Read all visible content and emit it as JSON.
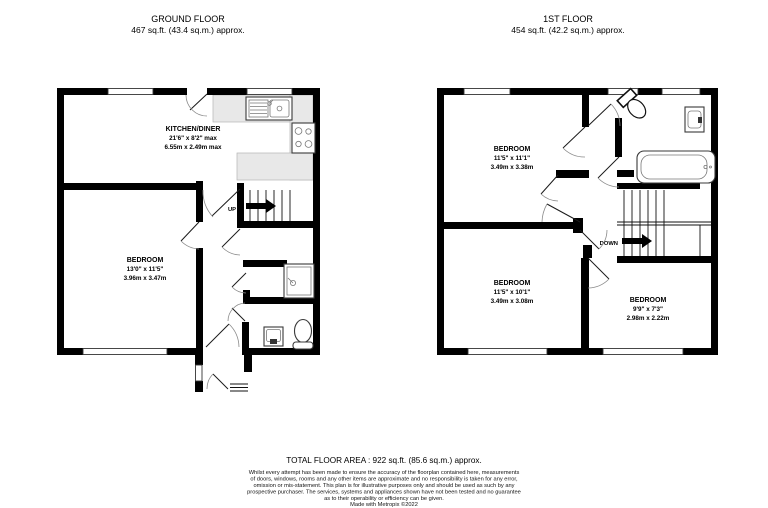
{
  "floors": [
    {
      "id": "ground-floor",
      "title": "GROUND FLOOR",
      "area": "467 sq.ft. (43.4 sq.m.) approx.",
      "stair_label": "UP",
      "rooms": [
        {
          "name": "KITCHEN/DINER",
          "dims_imperial": "21'6\" x 8'2\" max",
          "dims_metric": "6.55m x 2.49m max"
        },
        {
          "name": "BEDROOM",
          "dims_imperial": "13'0\" x 11'5\"",
          "dims_metric": "3.96m x 3.47m"
        }
      ]
    },
    {
      "id": "first-floor",
      "title": "1ST FLOOR",
      "area": "454 sq.ft. (42.2 sq.m.) approx.",
      "stair_label": "DOWN",
      "rooms": [
        {
          "name": "BEDROOM",
          "dims_imperial": "11'5\" x 11'1\"",
          "dims_metric": "3.49m x 3.38m"
        },
        {
          "name": "BEDROOM",
          "dims_imperial": "11'5\" x 10'1\"",
          "dims_metric": "3.49m x 3.08m"
        },
        {
          "name": "BEDROOM",
          "dims_imperial": "9'9\" x 7'3\"",
          "dims_metric": "2.98m x 2.22m"
        }
      ]
    }
  ],
  "footer": {
    "total_area": "TOTAL FLOOR AREA : 922 sq.ft. (85.6 sq.m.) approx.",
    "disclaimer_lines": [
      "Whilst every attempt has been made to ensure the accuracy of the floorplan contained here, measurements",
      "of doors, windows, rooms and any other items are approximate and no responsibility is taken for any error,",
      "omission or mis-statement. This plan is for illustrative purposes only and should be used as such by any",
      "prospective purchaser. The services, systems and appliances shown have not been tested and no guarantee",
      "as to their operability or efficiency can be given."
    ],
    "credit": "Made with Metropix ©2022"
  }
}
